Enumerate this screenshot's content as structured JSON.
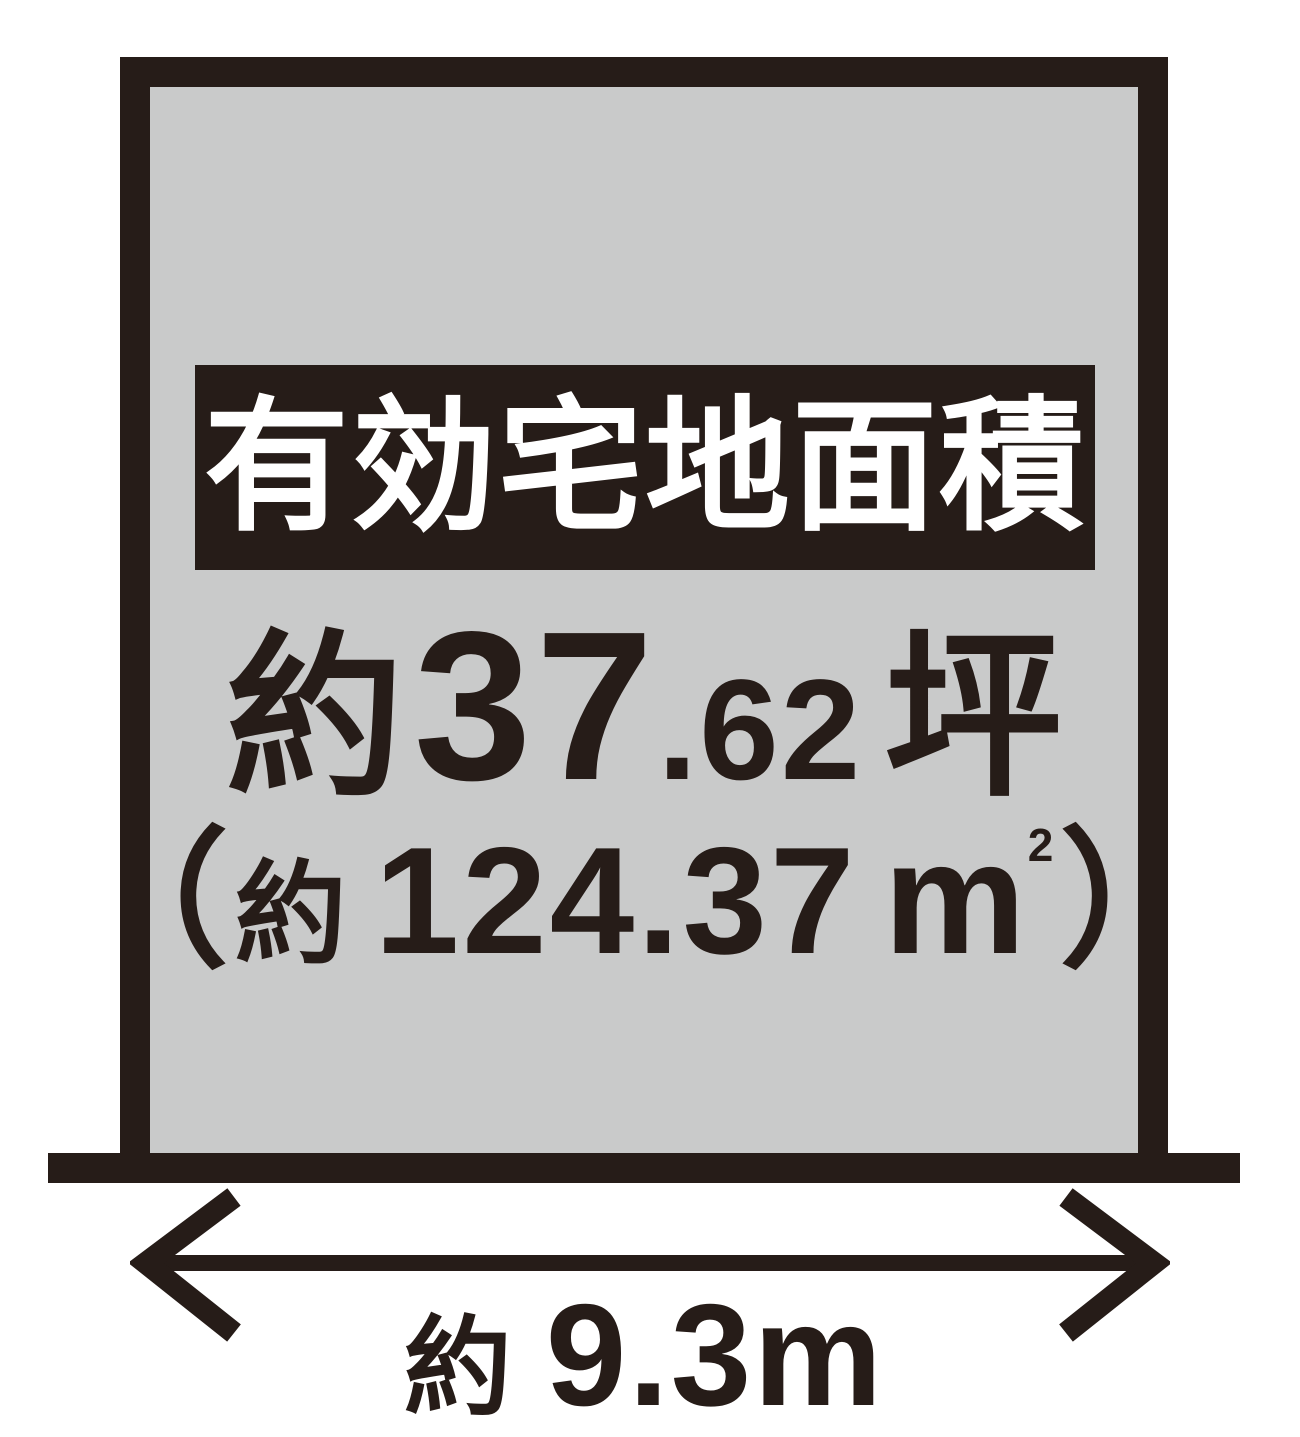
{
  "colors": {
    "ink": "#261c18",
    "plot_fill": "#c9caca",
    "banner_text": "#ffffff",
    "page_bg": "#ffffff"
  },
  "diagram": {
    "banner_label": "有効宅地面積",
    "area_tsubo": {
      "prefix": "約",
      "whole": "37",
      "decimal": ".62",
      "unit": "坪"
    },
    "area_sqm": {
      "paren_open": "（",
      "approx": "約",
      "value": "124.37",
      "unit_base": "m",
      "unit_exp": "2",
      "paren_close": "）"
    },
    "frontage": {
      "prefix": "約",
      "value": "9.3m"
    }
  }
}
